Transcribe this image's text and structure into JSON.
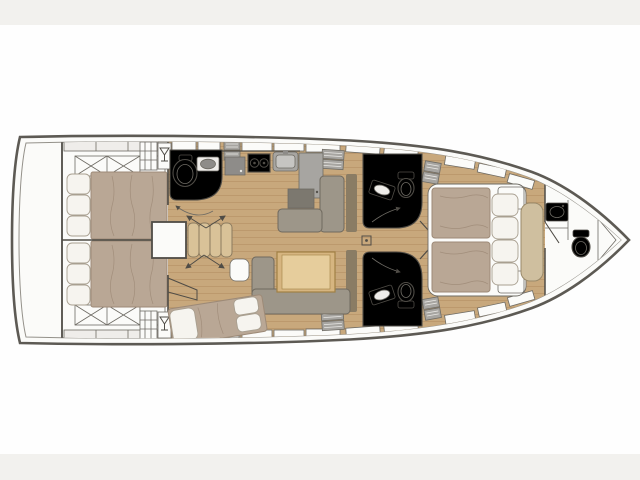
{
  "diagram": {
    "type": "floor-plan",
    "subject": "sailing-yacht-interior-layout-top-view",
    "orientation": "bow-right-stern-left",
    "rooms": [
      {
        "id": "swim-platform",
        "name": "swim platform / transom"
      },
      {
        "id": "aft-cabin-port",
        "name": "aft double cabin (top)"
      },
      {
        "id": "aft-cabin-starboard",
        "name": "aft double cabin (bottom)"
      },
      {
        "id": "aft-head-port",
        "name": "aft head with toilet and sink"
      },
      {
        "id": "galley",
        "name": "galley with stove, sink, refrigerator"
      },
      {
        "id": "salon",
        "name": "salon with L-sofa and nav table"
      },
      {
        "id": "dinette",
        "name": "dinette with table and U-sofa"
      },
      {
        "id": "mid-cabin-starboard",
        "name": "mid cabin with angled double berth"
      },
      {
        "id": "companionway",
        "name": "companionway steps"
      },
      {
        "id": "fwd-head-port",
        "name": "forward head (top)"
      },
      {
        "id": "fwd-head-starboard",
        "name": "forward head (bottom)"
      },
      {
        "id": "owner-cabin",
        "name": "forward owner cabin with island bed"
      },
      {
        "id": "bow-head",
        "name": "bow head with sink and toilet"
      },
      {
        "id": "anchor-locker",
        "name": "bow anchor locker"
      }
    ],
    "fixtures": [
      "toilet",
      "sink",
      "stove-2-burner",
      "refrigerator",
      "dining-table",
      "nav-table",
      "mast-post",
      "wet-bar-glass",
      "deck-hatch",
      "door-swing-arrow"
    ]
  },
  "colors": {
    "background": "#fefefe",
    "band": "#f2f1ee",
    "hull_stroke": "#5d5a54",
    "inner_stroke": "#94918a",
    "wall": "#4f4c46",
    "outline": "#6e6b64",
    "deck_white": "#fbfbf9",
    "deck_gray": "#efedea",
    "wood": "#c8a87c",
    "wood_line": "#b08e5f",
    "mattress": "#b9a795",
    "mattress_line": "#9d8a77",
    "pillow": "#f6f4ef",
    "pillow_line": "#a89f90",
    "sofa": "#9d9689",
    "sofa_line": "#6f695e",
    "sofa_dark": "#7c786f",
    "backrest": "#8a7c64",
    "table_wood": "#d6b580",
    "table_top": "#e6cd9c",
    "table_line": "#a08044",
    "counter": "#a7a5a1",
    "appliance": "#8e8c89",
    "seat_tan": "#cfbf9f",
    "seat_tan_line": "#9a8a6a",
    "step_wood": "#d9c298"
  }
}
